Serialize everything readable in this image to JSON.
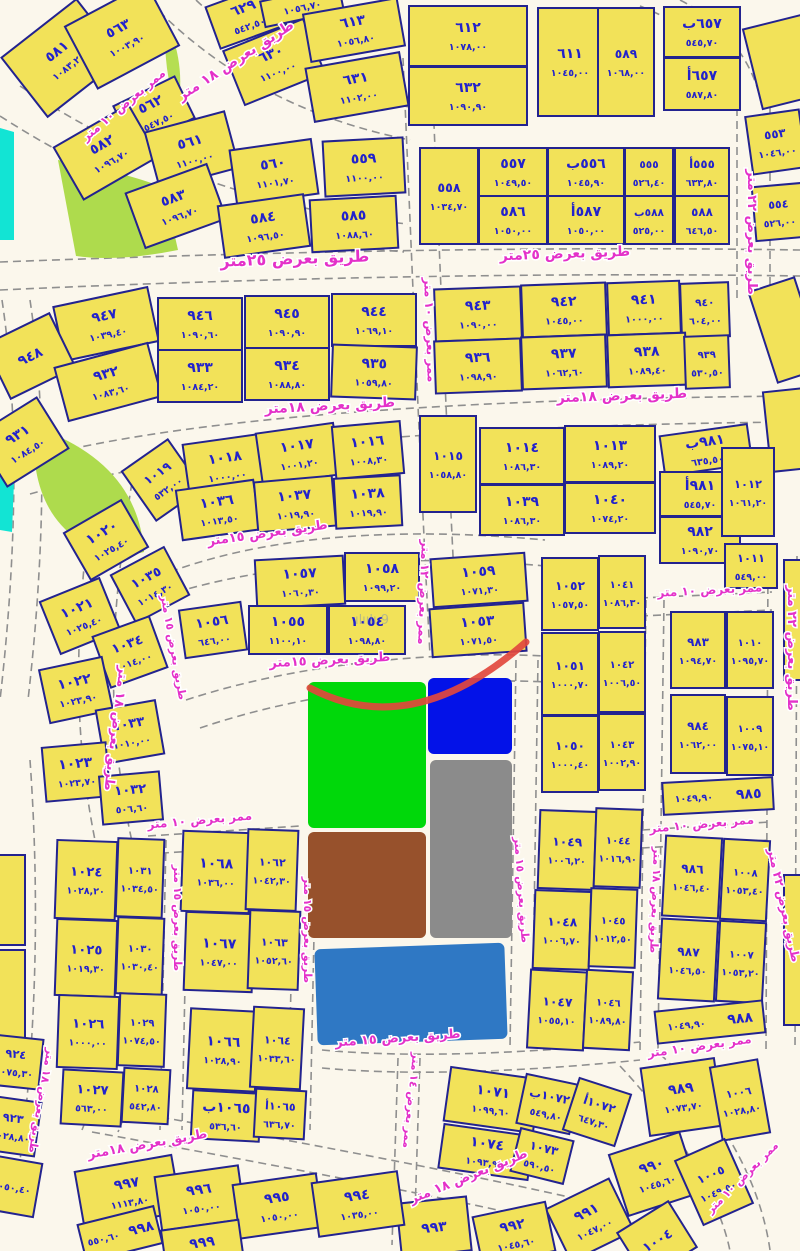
{
  "map_title": "cadastral-parcel-map",
  "colors": {
    "parcel_fill": "#F2E259",
    "parcel_border": "#23238f",
    "number_text": "#2222CC",
    "street_text": "#E431C9",
    "road_bg": "#FBF7EC",
    "zone_green": "#00D80A",
    "zone_blue": "#0312E8",
    "zone_gray": "#8B8B8B",
    "zone_brown": "#97512C",
    "zone_steelblue": "#2F78C4",
    "park_lime": "#AEDB4D",
    "park_cyan": "#12E4D4",
    "annotation_red": "#E2483D"
  },
  "watermark": "ılıılı 9",
  "parcels_format": "[cx, cy, w, h, rotation, plot_number, plot_area]",
  "parcels": [
    [
      62,
      58,
      95,
      75,
      -38,
      "٥٨١",
      "١٠٨٣,٢٠"
    ],
    [
      122,
      36,
      92,
      70,
      -28,
      "٥٦٣",
      "١٠٠٣,٩٠"
    ],
    [
      154,
      112,
      68,
      46,
      -26,
      "٥٦٢",
      "٥٤٧,٥٠"
    ],
    [
      106,
      152,
      86,
      60,
      -30,
      "٥٨٢",
      "١٠٩٦,٧٠"
    ],
    [
      192,
      150,
      82,
      58,
      -15,
      "٥٦١",
      "١١٠٠,٠٠"
    ],
    [
      176,
      206,
      86,
      58,
      -20,
      "٥٨٣",
      "١٠٩٦,٧٠"
    ],
    [
      274,
      172,
      82,
      55,
      -8,
      "٥٦٠",
      "١١٠١,٧٠"
    ],
    [
      264,
      226,
      86,
      52,
      -8,
      "٥٨٤",
      "١٠٩٦,٥٠"
    ],
    [
      364,
      167,
      80,
      55,
      -3,
      "٥٥٩",
      "١١٠٠,٠٠"
    ],
    [
      354,
      224,
      86,
      52,
      -3,
      "٥٨٥",
      "١٠٨٨,٦٠"
    ],
    [
      246,
      16,
      70,
      44,
      -20,
      "٦٢٩",
      "٥٤٢,٥٠"
    ],
    [
      274,
      62,
      86,
      58,
      -22,
      "٦٣٠",
      "١١٠٠,٠٠"
    ],
    [
      302,
      6,
      80,
      26,
      -12,
      "",
      "١٠٥٦,٧٠"
    ],
    [
      354,
      30,
      95,
      48,
      -10,
      "٦١٣",
      "١٠٥٦,٨٠"
    ],
    [
      357,
      87,
      95,
      54,
      -10,
      "٦٣١",
      "١١٠٢,٠٠"
    ],
    [
      468,
      36,
      118,
      60,
      0,
      "٦١٢",
      "١٠٧٨,٠٠"
    ],
    [
      468,
      96,
      118,
      58,
      0,
      "٦٣٢",
      "١٠٩٠,٩٠"
    ],
    [
      570,
      62,
      64,
      108,
      0,
      "٦١١",
      "١٠٤٥,٠٠"
    ],
    [
      626,
      62,
      56,
      108,
      0,
      "٥٨٩",
      "١٠٦٨,٠٠"
    ],
    [
      702,
      32,
      76,
      50,
      0,
      "٦٥٧ب",
      "٥٤٥,٧٠"
    ],
    [
      702,
      84,
      76,
      52,
      0,
      "٦٥٧أ",
      "٥٨٧,٨٠"
    ],
    [
      782,
      62,
      60,
      82,
      -14,
      "",
      ""
    ],
    [
      776,
      142,
      54,
      58,
      -8,
      "٥٥٣",
      "١٠٤٦,٠٠"
    ],
    [
      779,
      212,
      50,
      54,
      -5,
      "٥٥٤",
      "٥٢٦,٠٠"
    ],
    [
      449,
      196,
      58,
      96,
      0,
      "٥٥٨",
      "١٠٣٤,٧٠"
    ],
    [
      513,
      172,
      68,
      48,
      0,
      "٥٥٧",
      "١٠٤٩,٥٠"
    ],
    [
      586,
      172,
      76,
      48,
      0,
      "٥٥٦ب",
      "١٠٤٥,٩٠"
    ],
    [
      649,
      172,
      48,
      48,
      0,
      "٥٥٥",
      "٥٢٦,٤٠"
    ],
    [
      702,
      172,
      54,
      48,
      0,
      "٥٥٥أ",
      "٦٣٣,٨٠"
    ],
    [
      513,
      220,
      68,
      48,
      0,
      "٥٨٦",
      "١٠٥٠,٠٠"
    ],
    [
      586,
      220,
      76,
      48,
      0,
      "٥٨٧أ",
      "١٠٥٠,٠٠"
    ],
    [
      649,
      220,
      48,
      48,
      0,
      "٥٨٨ب",
      "٥٢٥,٠٠"
    ],
    [
      702,
      220,
      54,
      48,
      0,
      "٥٨٨",
      "٦٤٦,٥٠"
    ],
    [
      106,
      324,
      96,
      55,
      -12,
      "٩٤٧",
      "١٠٣٩,٤٠"
    ],
    [
      30,
      356,
      72,
      60,
      -26,
      "٩٤٨",
      ""
    ],
    [
      108,
      382,
      96,
      55,
      -15,
      "٩٣٢",
      "١٠٨٣,٦٠"
    ],
    [
      22,
      442,
      72,
      60,
      -32,
      "٩٣١",
      "١٠٨٤,٥٠"
    ],
    [
      200,
      324,
      84,
      52,
      0,
      "٩٤٦",
      "١٠٩٠,٦٠"
    ],
    [
      287,
      322,
      84,
      52,
      0,
      "٩٤٥",
      "١٠٩٠,٩٠"
    ],
    [
      374,
      320,
      84,
      52,
      0,
      "٩٤٤",
      "١٠٦٩,١٠"
    ],
    [
      200,
      376,
      84,
      52,
      0,
      "٩٣٣",
      "١٠٨٤,٢٠"
    ],
    [
      287,
      374,
      84,
      52,
      0,
      "٩٣٤",
      "١٠٨٨,٨٠"
    ],
    [
      374,
      372,
      84,
      52,
      2,
      "٩٣٥",
      "١٠٥٩,٨٠"
    ],
    [
      478,
      314,
      86,
      52,
      -2,
      "٩٤٣",
      "١٠٩٠,٠٠"
    ],
    [
      564,
      310,
      84,
      52,
      -2,
      "٩٤٢",
      "١٠٤٥,٠٠"
    ],
    [
      644,
      308,
      72,
      52,
      -2,
      "٩٤١",
      "١٠٠٠,٠٠"
    ],
    [
      705,
      310,
      48,
      54,
      -2,
      "٩٤٠",
      "٦٠٤,٠٠"
    ],
    [
      478,
      366,
      86,
      52,
      -2,
      "٩٣٦",
      "١٠٩٨,٩٠"
    ],
    [
      564,
      362,
      84,
      52,
      -2,
      "٩٣٧",
      "١٠٦٢,٦٠"
    ],
    [
      647,
      360,
      78,
      52,
      -2,
      "٩٣٨",
      "١٠٨٩,٤٠"
    ],
    [
      707,
      362,
      44,
      52,
      -2,
      "٩٣٩",
      "٥٣٠,٥٠"
    ],
    [
      786,
      330,
      48,
      95,
      -18,
      "",
      ""
    ],
    [
      788,
      430,
      42,
      80,
      -6,
      "",
      ""
    ],
    [
      162,
      480,
      56,
      60,
      -35,
      "١٠١٩",
      "٥٣٢,٠٠"
    ],
    [
      226,
      466,
      80,
      54,
      -8,
      "١٠١٨",
      "١٠٠٠,٠٠"
    ],
    [
      298,
      454,
      78,
      52,
      -8,
      "١٠١٧",
      "١٠٠١,٢٠"
    ],
    [
      368,
      450,
      68,
      52,
      -5,
      "١٠١٦",
      "١٠٠٨,٣٠"
    ],
    [
      448,
      464,
      56,
      96,
      0,
      "١٠١٥",
      "١٠٥٨,٨٠"
    ],
    [
      522,
      456,
      84,
      56,
      0,
      "١٠١٤",
      "١٠٨٦,٣٠"
    ],
    [
      610,
      454,
      90,
      56,
      0,
      "١٠١٣",
      "١٠٨٩,٢٠"
    ],
    [
      218,
      510,
      78,
      50,
      -8,
      "١٠٣٦",
      "١٠١٣,٥٠"
    ],
    [
      295,
      504,
      78,
      50,
      -5,
      "١٠٣٧",
      "١٠١٩,٩٠"
    ],
    [
      368,
      502,
      66,
      50,
      -3,
      "١٠٣٨",
      "١٠١٩,٩٠"
    ],
    [
      522,
      510,
      84,
      50,
      0,
      "١٠٣٩",
      "١٠٨٦,٣٠"
    ],
    [
      610,
      508,
      90,
      50,
      0,
      "١٠٤٠",
      "١٠٧٤,٢٠"
    ],
    [
      706,
      450,
      88,
      40,
      -8,
      "٩٨١ب",
      "٦٣٥,٥٠"
    ],
    [
      700,
      494,
      80,
      44,
      0,
      "٩٨١أ",
      "٥٤٥,٧٠"
    ],
    [
      700,
      540,
      80,
      46,
      0,
      "٩٨٢",
      "١٠٩٠,٧٠"
    ],
    [
      748,
      492,
      52,
      88,
      0,
      "١٠١٢",
      "١٠٦١,٢٠"
    ],
    [
      751,
      566,
      52,
      44,
      0,
      "١٠١١",
      "٥٤٩,٠٠"
    ],
    [
      106,
      540,
      66,
      54,
      -30,
      "١٠٢٠",
      "١٠٢٥,٤٠"
    ],
    [
      150,
      585,
      60,
      54,
      -28,
      "١٠٣٥",
      "١٠١٤,٣٠"
    ],
    [
      80,
      616,
      64,
      56,
      -22,
      "١٠٢١",
      "١٠٢٥,٤٠"
    ],
    [
      130,
      652,
      60,
      54,
      -20,
      "١٠٣٤",
      "١٠١٤,٠٠"
    ],
    [
      76,
      690,
      64,
      54,
      -12,
      "١٠٢٢",
      "١٠٢٣,٩٠"
    ],
    [
      130,
      732,
      60,
      54,
      -10,
      "١٠٣٣",
      "١٠١٠,٠٠"
    ],
    [
      76,
      772,
      64,
      54,
      -5,
      "١٠٢٣",
      "١٠٢٣,٧٠"
    ],
    [
      131,
      798,
      60,
      48,
      -5,
      "١٠٣٢",
      "٥٠٦,٦٠"
    ],
    [
      300,
      582,
      88,
      48,
      -3,
      "١٠٥٧",
      "١٠٦٠,٣٠"
    ],
    [
      382,
      577,
      74,
      48,
      0,
      "١٠٥٨",
      "١٠٩٩,٢٠"
    ],
    [
      213,
      630,
      62,
      48,
      -8,
      "١٠٥٦",
      "٦٤٦,٠٠"
    ],
    [
      288,
      630,
      78,
      48,
      0,
      "١٠٥٥",
      "١١٠٠,١٠"
    ],
    [
      367,
      630,
      76,
      48,
      0,
      "١٠٥٤",
      "١٠٩٨,٨٠"
    ],
    [
      479,
      580,
      94,
      48,
      -4,
      "١٠٥٩",
      "١٠٧١,٣٠"
    ],
    [
      478,
      630,
      94,
      48,
      -4,
      "١٠٥٣",
      "١٠٧١,٥٠"
    ],
    [
      570,
      594,
      56,
      72,
      0,
      "١٠٥٢",
      "١٠٥٧,٥٠"
    ],
    [
      622,
      592,
      46,
      72,
      0,
      "١٠٤١",
      "١٠٨٦,٣٠"
    ],
    [
      570,
      674,
      56,
      82,
      0,
      "١٠٥١",
      "١٠٠٠,٧٠"
    ],
    [
      622,
      672,
      46,
      80,
      0,
      "١٠٤٢",
      "١٠٠٦,٥٠"
    ],
    [
      570,
      754,
      56,
      76,
      0,
      "١٠٥٠",
      "١٠٠٠,٤٠"
    ],
    [
      622,
      752,
      46,
      76,
      0,
      "١٠٤٣",
      "١٠٠٢,٩٠"
    ],
    [
      698,
      650,
      54,
      76,
      0,
      "٩٨٣",
      "١٠٩٤,٧٠"
    ],
    [
      750,
      650,
      46,
      76,
      0,
      "١٠١٠",
      "١٠٩٥,٧٠"
    ],
    [
      698,
      734,
      54,
      78,
      0,
      "٩٨٤",
      "١٠٦٢,٠٠"
    ],
    [
      750,
      736,
      46,
      78,
      0,
      "١٠٠٩",
      "١٠٧٥,١٠"
    ],
    [
      718,
      796,
      110,
      32,
      -3,
      "٩٨٥",
      "١٠٤٩,٩٠"
    ],
    [
      797,
      620,
      26,
      120,
      0,
      "",
      ""
    ],
    [
      797,
      950,
      26,
      150,
      0,
      "",
      ""
    ],
    [
      567,
      850,
      56,
      78,
      2,
      "١٠٤٩",
      "١٠٠٦,٢٠"
    ],
    [
      618,
      848,
      46,
      78,
      2,
      "١٠٤٤",
      "١٠١٦,٩٠"
    ],
    [
      562,
      930,
      56,
      78,
      2,
      "١٠٤٨",
      "١٠٠٦,٧٠"
    ],
    [
      613,
      928,
      46,
      78,
      2,
      "١٠٤٥",
      "١٠١٢,٥٠"
    ],
    [
      557,
      1010,
      56,
      78,
      3,
      "١٠٤٧",
      "١٠٥٥,١٠"
    ],
    [
      608,
      1010,
      46,
      78,
      3,
      "١٠٤٦",
      "١٠٨٩,٨٠"
    ],
    [
      692,
      877,
      56,
      80,
      3,
      "٩٨٦",
      "١٠٤٦,٤٠"
    ],
    [
      745,
      880,
      46,
      80,
      3,
      "١٠٠٨",
      "١٠٥٣,٤٠"
    ],
    [
      688,
      960,
      56,
      80,
      3,
      "٩٨٧",
      "١٠٤٦,٥٠"
    ],
    [
      741,
      962,
      46,
      80,
      3,
      "١٠٠٧",
      "١٠٥٣,٢٠"
    ],
    [
      710,
      1022,
      108,
      32,
      -6,
      "٩٨٨",
      "١٠٤٩,٩٠"
    ],
    [
      86,
      880,
      60,
      78,
      2,
      "١٠٢٤",
      "١٠٢٨,٢٠"
    ],
    [
      140,
      878,
      46,
      78,
      2,
      "١٠٣١",
      "١٠٣٤,٥٠"
    ],
    [
      86,
      958,
      60,
      76,
      2,
      "١٠٢٥",
      "١٠١٩,٣٠"
    ],
    [
      140,
      956,
      46,
      76,
      2,
      "١٠٣٠",
      "١٠٣٠,٤٠"
    ],
    [
      88,
      1032,
      60,
      72,
      2,
      "١٠٢٦",
      "١٠٠٠,٠٠"
    ],
    [
      142,
      1030,
      46,
      72,
      2,
      "١٠٢٩",
      "١٠٧٤,٥٠"
    ],
    [
      92,
      1098,
      60,
      54,
      3,
      "١٠٢٧",
      "٥٦٣,٠٠"
    ],
    [
      146,
      1096,
      46,
      54,
      3,
      "١٠٢٨",
      "٥٤٢,٨٠"
    ],
    [
      10,
      900,
      30,
      90,
      0,
      "",
      ""
    ],
    [
      10,
      995,
      30,
      90,
      0,
      "",
      ""
    ],
    [
      216,
      872,
      68,
      80,
      2,
      "١٠٦٨",
      "١٠٣٦,٠٠"
    ],
    [
      272,
      870,
      50,
      80,
      2,
      "١٠٦٢",
      "١٠٤٢,٣٠"
    ],
    [
      219,
      952,
      68,
      78,
      2,
      "١٠٦٧",
      "١٠٤٧,٠٠"
    ],
    [
      274,
      950,
      50,
      78,
      2,
      "١٠٦٣",
      "١٠٥٢,٦٠"
    ],
    [
      223,
      1050,
      68,
      80,
      3,
      "١٠٦٦",
      "١٠٢٨,٩٠"
    ],
    [
      277,
      1048,
      50,
      80,
      3,
      "١٠٦٤",
      "١٠٣٣,٦٠"
    ],
    [
      226,
      1116,
      68,
      48,
      3,
      "١٠٦٥ب",
      "٥٣٦,٦٠"
    ],
    [
      280,
      1114,
      50,
      48,
      3,
      "١٠٦٥أ",
      "٦٣٦,٧٠"
    ],
    [
      15,
      1062,
      52,
      50,
      6,
      "٩٢٤",
      "١٠٧٥,٣٠"
    ],
    [
      12,
      1126,
      52,
      54,
      8,
      "٩٢٣",
      "١٠٢٨,٨٠"
    ],
    [
      12,
      1186,
      52,
      54,
      10,
      "",
      "١٠٥٠,٤٠"
    ],
    [
      492,
      1100,
      90,
      54,
      8,
      "١٠٧١",
      "١٠٩٩,٦٠"
    ],
    [
      548,
      1104,
      54,
      50,
      12,
      "١٠٧٢ب",
      "٥٤٩,٨٠"
    ],
    [
      597,
      1112,
      54,
      54,
      18,
      "١٠٧٢أ",
      "٦٤٧,٣٠"
    ],
    [
      486,
      1152,
      90,
      44,
      8,
      "١٠٧٤",
      "١٠٩٣,٩٠"
    ],
    [
      542,
      1156,
      54,
      44,
      14,
      "١٠٧٣",
      "٥٩٠,٥٠"
    ],
    [
      682,
      1097,
      74,
      68,
      -8,
      "٩٨٩",
      "١٠٧٣,٧٠"
    ],
    [
      740,
      1100,
      48,
      74,
      -10,
      "١٠٠٦",
      "١٠٢٨,٨٠"
    ],
    [
      654,
      1174,
      74,
      64,
      -18,
      "٩٩٠",
      "١٠٤٥,٦٠"
    ],
    [
      714,
      1182,
      54,
      70,
      -24,
      "١٠٠٥",
      "١٠٤٩,٥٠"
    ],
    [
      590,
      1220,
      70,
      58,
      -26,
      "٩٩١",
      "١٠٤٧,٠٠"
    ],
    [
      657,
      1240,
      60,
      54,
      -32,
      "١٠٠٤",
      ""
    ],
    [
      514,
      1234,
      74,
      50,
      -12,
      "٩٩٢",
      "١٠٤٥,٦٠"
    ],
    [
      434,
      1227,
      70,
      54,
      -6,
      "٩٩٣",
      ""
    ],
    [
      128,
      1192,
      98,
      58,
      -10,
      "٩٩٧",
      "١١١٣,٨٠"
    ],
    [
      200,
      1198,
      84,
      54,
      -8,
      "٩٩٦",
      "١٠٥٠,٠٠"
    ],
    [
      278,
      1206,
      84,
      54,
      -8,
      "٩٩٥",
      "١٠٥٠,٠٠"
    ],
    [
      358,
      1204,
      86,
      54,
      -8,
      "٩٩٤",
      "١٠٣٥,٠٠"
    ],
    [
      120,
      1234,
      78,
      38,
      -14,
      "٩٩٨",
      "٥٥٠,٦٠"
    ],
    [
      202,
      1242,
      78,
      34,
      -8,
      "٩٩٩",
      ""
    ]
  ],
  "streets_format": "[x, y, rotation, label, font_size]",
  "streets": [
    [
      295,
      264,
      -2,
      "طريق بعرض ٢٥متر",
      16
    ],
    [
      565,
      258,
      -2,
      "طريق بعرض ٢٥متر",
      14
    ],
    [
      238,
      64,
      -33,
      "طريق بعرض ١٨ متر",
      14
    ],
    [
      126,
      108,
      -40,
      "ممر بعرض ١٠ متر",
      12
    ],
    [
      330,
      410,
      -3,
      "طريق بعرض ١٨متر",
      14
    ],
    [
      622,
      400,
      -2,
      "طريق بعرض ١٨متر",
      14
    ],
    [
      268,
      537,
      -8,
      "طريق بعرض ١٥متر",
      13
    ],
    [
      330,
      664,
      -3,
      "طريق بعرض ١٥متر",
      13
    ],
    [
      398,
      1042,
      -4,
      "طريق بعرض ١٥ متر",
      13
    ],
    [
      148,
      1148,
      -10,
      "طريق بعرض ١٨متر",
      13
    ],
    [
      470,
      1180,
      -22,
      "طريق بعرض ١٨ متر",
      13
    ],
    [
      748,
      232,
      90,
      "طريق بعرض ٢٢ متر",
      13
    ],
    [
      788,
      648,
      90,
      "طريق بعرض ٢٢ متر",
      13
    ],
    [
      780,
      906,
      78,
      "طريق بعرض ٢٢ متر",
      12
    ],
    [
      426,
      330,
      88,
      "ممر بعرض ١٠ متر",
      12
    ],
    [
      420,
      592,
      92,
      "ممر بعرض ١٢ متر",
      12
    ],
    [
      710,
      594,
      -3,
      "ممر بعرض ١٠ متر",
      12
    ],
    [
      702,
      828,
      -5,
      "ممر بعرض ١٠ متر",
      12
    ],
    [
      200,
      824,
      -5,
      "ممر بعرض ١٠ متر",
      12
    ],
    [
      700,
      1050,
      -8,
      "ممر بعرض ١٠ متر",
      12
    ],
    [
      112,
      728,
      97,
      "طريق بعرض ١٨ متر",
      13
    ],
    [
      170,
      648,
      80,
      "طريق بعرض ١٥ متر",
      11
    ],
    [
      174,
      918,
      90,
      "طريق بعرض ١٥ متر",
      11
    ],
    [
      304,
      930,
      90,
      "طريق بعرض ١٥ متر",
      11
    ],
    [
      518,
      890,
      86,
      "طريق بعرض ١٥ متر",
      11
    ],
    [
      652,
      900,
      92,
      "طريق بعرض ١٨ متر",
      11
    ],
    [
      408,
      1100,
      96,
      "ممر بعرض ١٤ متر",
      11
    ],
    [
      38,
      1100,
      100,
      "طريق بعرض ١٨ متر",
      11
    ],
    [
      745,
      1180,
      -45,
      "ممر بعرض ١٠ متر",
      11
    ]
  ],
  "zones": [
    {
      "name": "zone-green",
      "x": 308,
      "y": 682,
      "w": 118,
      "h": 146,
      "r": 0,
      "fill": "#00D80A"
    },
    {
      "name": "zone-blue",
      "x": 428,
      "y": 678,
      "w": 84,
      "h": 76,
      "r": 0,
      "fill": "#0312E8"
    },
    {
      "name": "zone-gray",
      "x": 430,
      "y": 760,
      "w": 82,
      "h": 178,
      "r": 0,
      "fill": "#8B8B8B"
    },
    {
      "name": "zone-brown",
      "x": 308,
      "y": 832,
      "w": 118,
      "h": 106,
      "r": 0,
      "fill": "#97512C"
    },
    {
      "name": "zone-steelblue",
      "x": 316,
      "y": 946,
      "w": 190,
      "h": 96,
      "r": -2,
      "fill": "#2F78C4"
    }
  ],
  "parks": [
    {
      "name": "park-lime-mid",
      "path": "M 58 160 Q 132 174 164 188 L 178 250 Q 118 262 76 256 Z",
      "fill": "#AEDB4D"
    },
    {
      "name": "park-lime-crescent",
      "path": "M 38 428 Q 138 464 144 552 L 120 558 Q 48 540 36 470 Z",
      "fill": "#AEDB4D"
    },
    {
      "name": "park-cyan-strip-top",
      "path": "M 0 128 L 14 132 L 14 240 L 0 240 Z",
      "fill": "#12E4D4"
    },
    {
      "name": "park-cyan-strip-mid",
      "path": "M 0 425 L 16 430 L 12 532 L 0 530 Z",
      "fill": "#12E4D4"
    },
    {
      "name": "park-lime-sliver-top",
      "path": "M 166 22 Q 186 60 178 112 Q 162 70 166 22 Z",
      "fill": "#B5DE52"
    }
  ],
  "annotation": {
    "name": "red-arc",
    "path": "M 310 688 Q 412 742 526 642",
    "color": "#E2483D"
  }
}
